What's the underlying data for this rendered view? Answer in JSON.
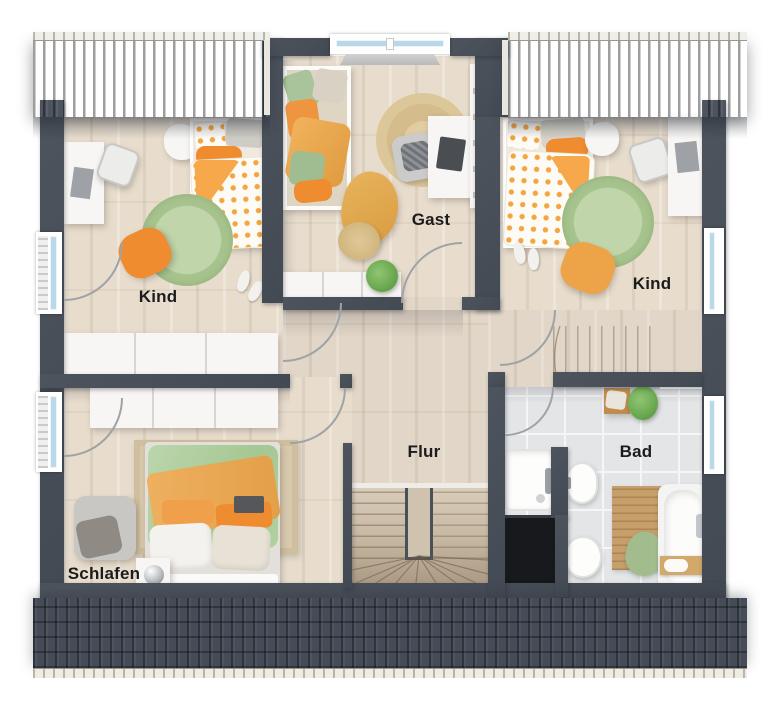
{
  "floorplan": {
    "title": "Obergeschoss Grundriss",
    "rooms": [
      {
        "id": "kind-left",
        "label": "Kind"
      },
      {
        "id": "gast",
        "label": "Gast"
      },
      {
        "id": "kind-right",
        "label": "Kind"
      },
      {
        "id": "schlafen",
        "label": "Schlafen"
      },
      {
        "id": "flur",
        "label": "Flur"
      },
      {
        "id": "bad",
        "label": "Bad"
      }
    ],
    "features": {
      "stairs": "U-shaped staircase in hallway, straight flight on landing",
      "windows": [
        "west wall x2 with radiators",
        "east wall x2",
        "dormer window above Gast"
      ],
      "fixtures": [
        "shower",
        "washbasin",
        "toilet",
        "bathtub"
      ]
    },
    "colors": {
      "roof": "#49505c",
      "roof_dark": "#3a404a",
      "wall": "#474d56",
      "wood_floor": "#e8ddcd",
      "tile_floor": "#e3e5e7",
      "rug_green": "#b6cf9d",
      "rug_jute": "#dcc79a",
      "accent_orange": "#ef8c30",
      "accent_green": "#aecb9c",
      "stair_wood": "#d2c5b1",
      "void": "#17191c",
      "gutter": "#ece9e2",
      "window_glass": "#b9d8ea"
    }
  }
}
